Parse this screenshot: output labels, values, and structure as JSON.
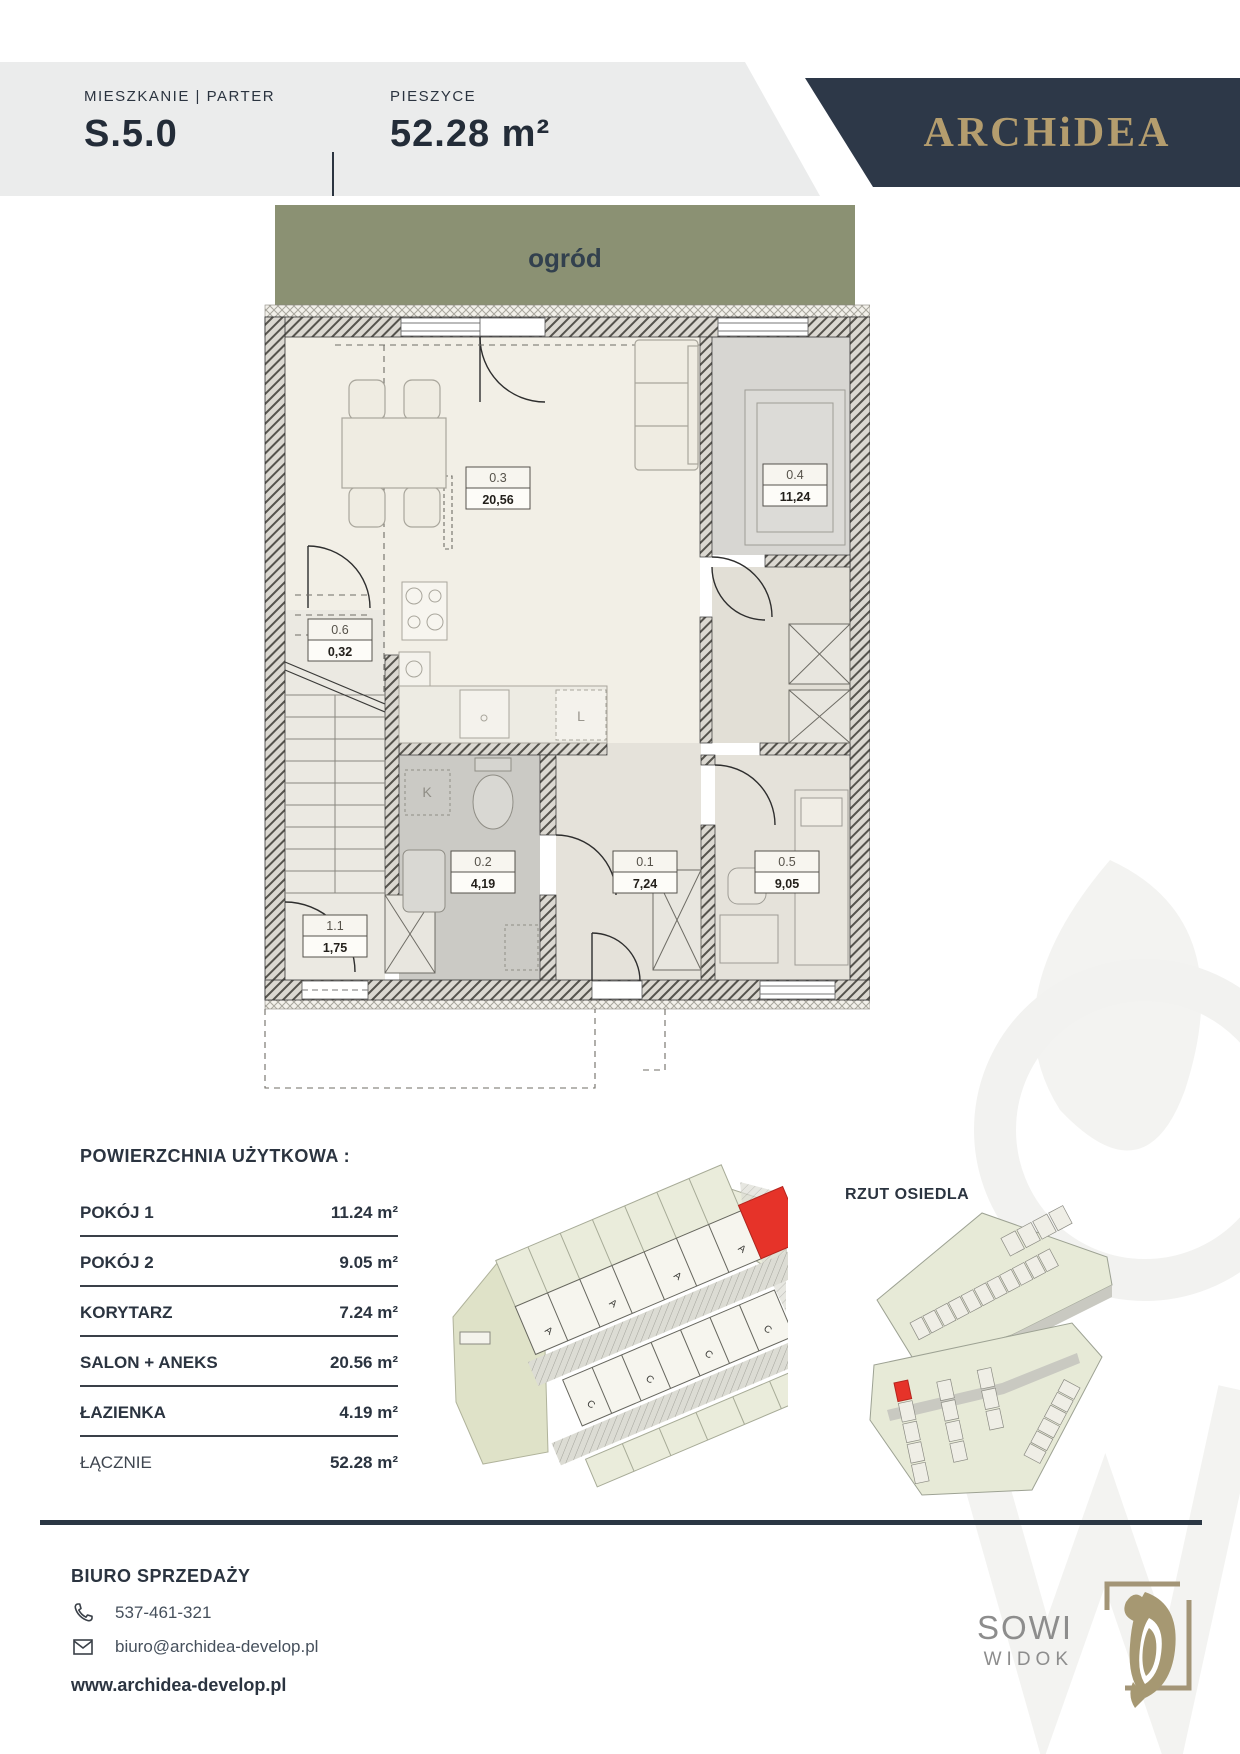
{
  "header": {
    "category": "MIESZKANIE | PARTER",
    "unit": "S.5.0",
    "city": "PIESZYCE",
    "area": "52.28 m²",
    "brand": "ARCHiDEA"
  },
  "plan": {
    "garden": "ogród",
    "fridge": "L",
    "washer": "K",
    "rooms": [
      {
        "id": "0.3",
        "area": "20,56"
      },
      {
        "id": "0.4",
        "area": "11,24"
      },
      {
        "id": "0.6",
        "area": "0,32"
      },
      {
        "id": "0.2",
        "area": "4,19"
      },
      {
        "id": "0.1",
        "area": "7,24"
      },
      {
        "id": "0.5",
        "area": "9,05"
      },
      {
        "id": "1.1",
        "area": "1,75"
      }
    ]
  },
  "areas": {
    "title": "POWIERZCHNIA UŻYTKOWA :",
    "rows": [
      {
        "label": "POKÓJ 1",
        "value": "11.24 m²"
      },
      {
        "label": "POKÓJ 2",
        "value": "9.05 m²"
      },
      {
        "label": "KORYTARZ",
        "value": "7.24 m²"
      },
      {
        "label": "SALON + ANEKS",
        "value": "20.56 m²"
      },
      {
        "label": "ŁAZIENKA",
        "value": "4.19 m²"
      }
    ],
    "total": {
      "label": "ŁĄCZNIE",
      "value": "52.28 m²"
    }
  },
  "site": {
    "estate_title": "RZUT OSIEDLA",
    "type_a": "A",
    "type_c": "C"
  },
  "footer": {
    "office": "BIURO SPRZEDAŻY",
    "phone": "537-461-321",
    "email": "biuro@archidea-develop.pl",
    "website": "www.archidea-develop.pl"
  },
  "logo": {
    "line1": "SOWI",
    "line2": "WIDOK"
  },
  "colors": {
    "navy": "#2d3848",
    "gold": "#b49d6e",
    "garden_green": "#8b9173",
    "highlight_red": "#e63329"
  }
}
